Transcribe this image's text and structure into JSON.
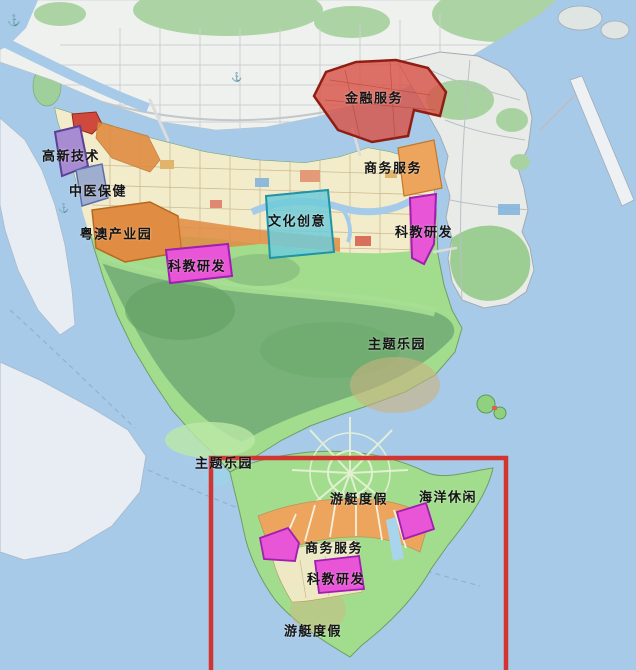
{
  "map": {
    "labels": [
      {
        "id": "financial-services",
        "text": "金融服务",
        "x": 374,
        "y": 97
      },
      {
        "id": "hi-tech",
        "text": "高新技术",
        "x": 71,
        "y": 155
      },
      {
        "id": "tcm-healthcare",
        "text": "中医保健",
        "x": 98,
        "y": 190
      },
      {
        "id": "yueao-industrial-park",
        "text": "粤澳产业园",
        "x": 116,
        "y": 233
      },
      {
        "id": "business-services-north",
        "text": "商务服务",
        "x": 393,
        "y": 167
      },
      {
        "id": "cultural-creativity",
        "text": "文化创意",
        "x": 297,
        "y": 220
      },
      {
        "id": "sci-edu-rd-east",
        "text": "科教研发",
        "x": 424,
        "y": 231
      },
      {
        "id": "sci-edu-rd-west",
        "text": "科教研发",
        "x": 197,
        "y": 265
      },
      {
        "id": "theme-park-east",
        "text": "主题乐园",
        "x": 397,
        "y": 343
      },
      {
        "id": "theme-park-west",
        "text": "主题乐园",
        "x": 224,
        "y": 462
      },
      {
        "id": "yacht-resort-north",
        "text": "游艇度假",
        "x": 359,
        "y": 498
      },
      {
        "id": "ocean-leisure",
        "text": "海洋休闲",
        "x": 448,
        "y": 496
      },
      {
        "id": "business-services-south",
        "text": "商务服务",
        "x": 334,
        "y": 547
      },
      {
        "id": "sci-edu-rd-south",
        "text": "科教研发",
        "x": 336,
        "y": 578
      },
      {
        "id": "yacht-resort-south",
        "text": "游艇度假",
        "x": 313,
        "y": 630
      }
    ],
    "colors": {
      "sea": "#a7cae9",
      "mainland": "#eff1ee",
      "pale_land": "#e8edf3",
      "macau": "#e9ebe8",
      "island_green": "#a2dd8e",
      "island_cream": "#f3ecca",
      "mountain_green": "#79b279",
      "hill_green": "#abd3a3",
      "financial_zone": "#d85348",
      "financial_border": "#8f1d12",
      "hitech_zone": "#a78cd2",
      "hitech_border": "#5d3e99",
      "tcm_zone": "#9fadcf",
      "tcm_border": "#5a6eae",
      "industrial_zone": "#e08c42",
      "industrial_border": "#b5681e",
      "cultural_zone": "#6fcbd9",
      "cultural_border": "#1f93a8",
      "business_zone": "#eda45c",
      "business_border": "#c47828",
      "research_zone": "#e855d6",
      "research_border": "#a01eb0",
      "highlight_box": "#d23430"
    },
    "icons": {
      "anchor": "⚓"
    }
  }
}
